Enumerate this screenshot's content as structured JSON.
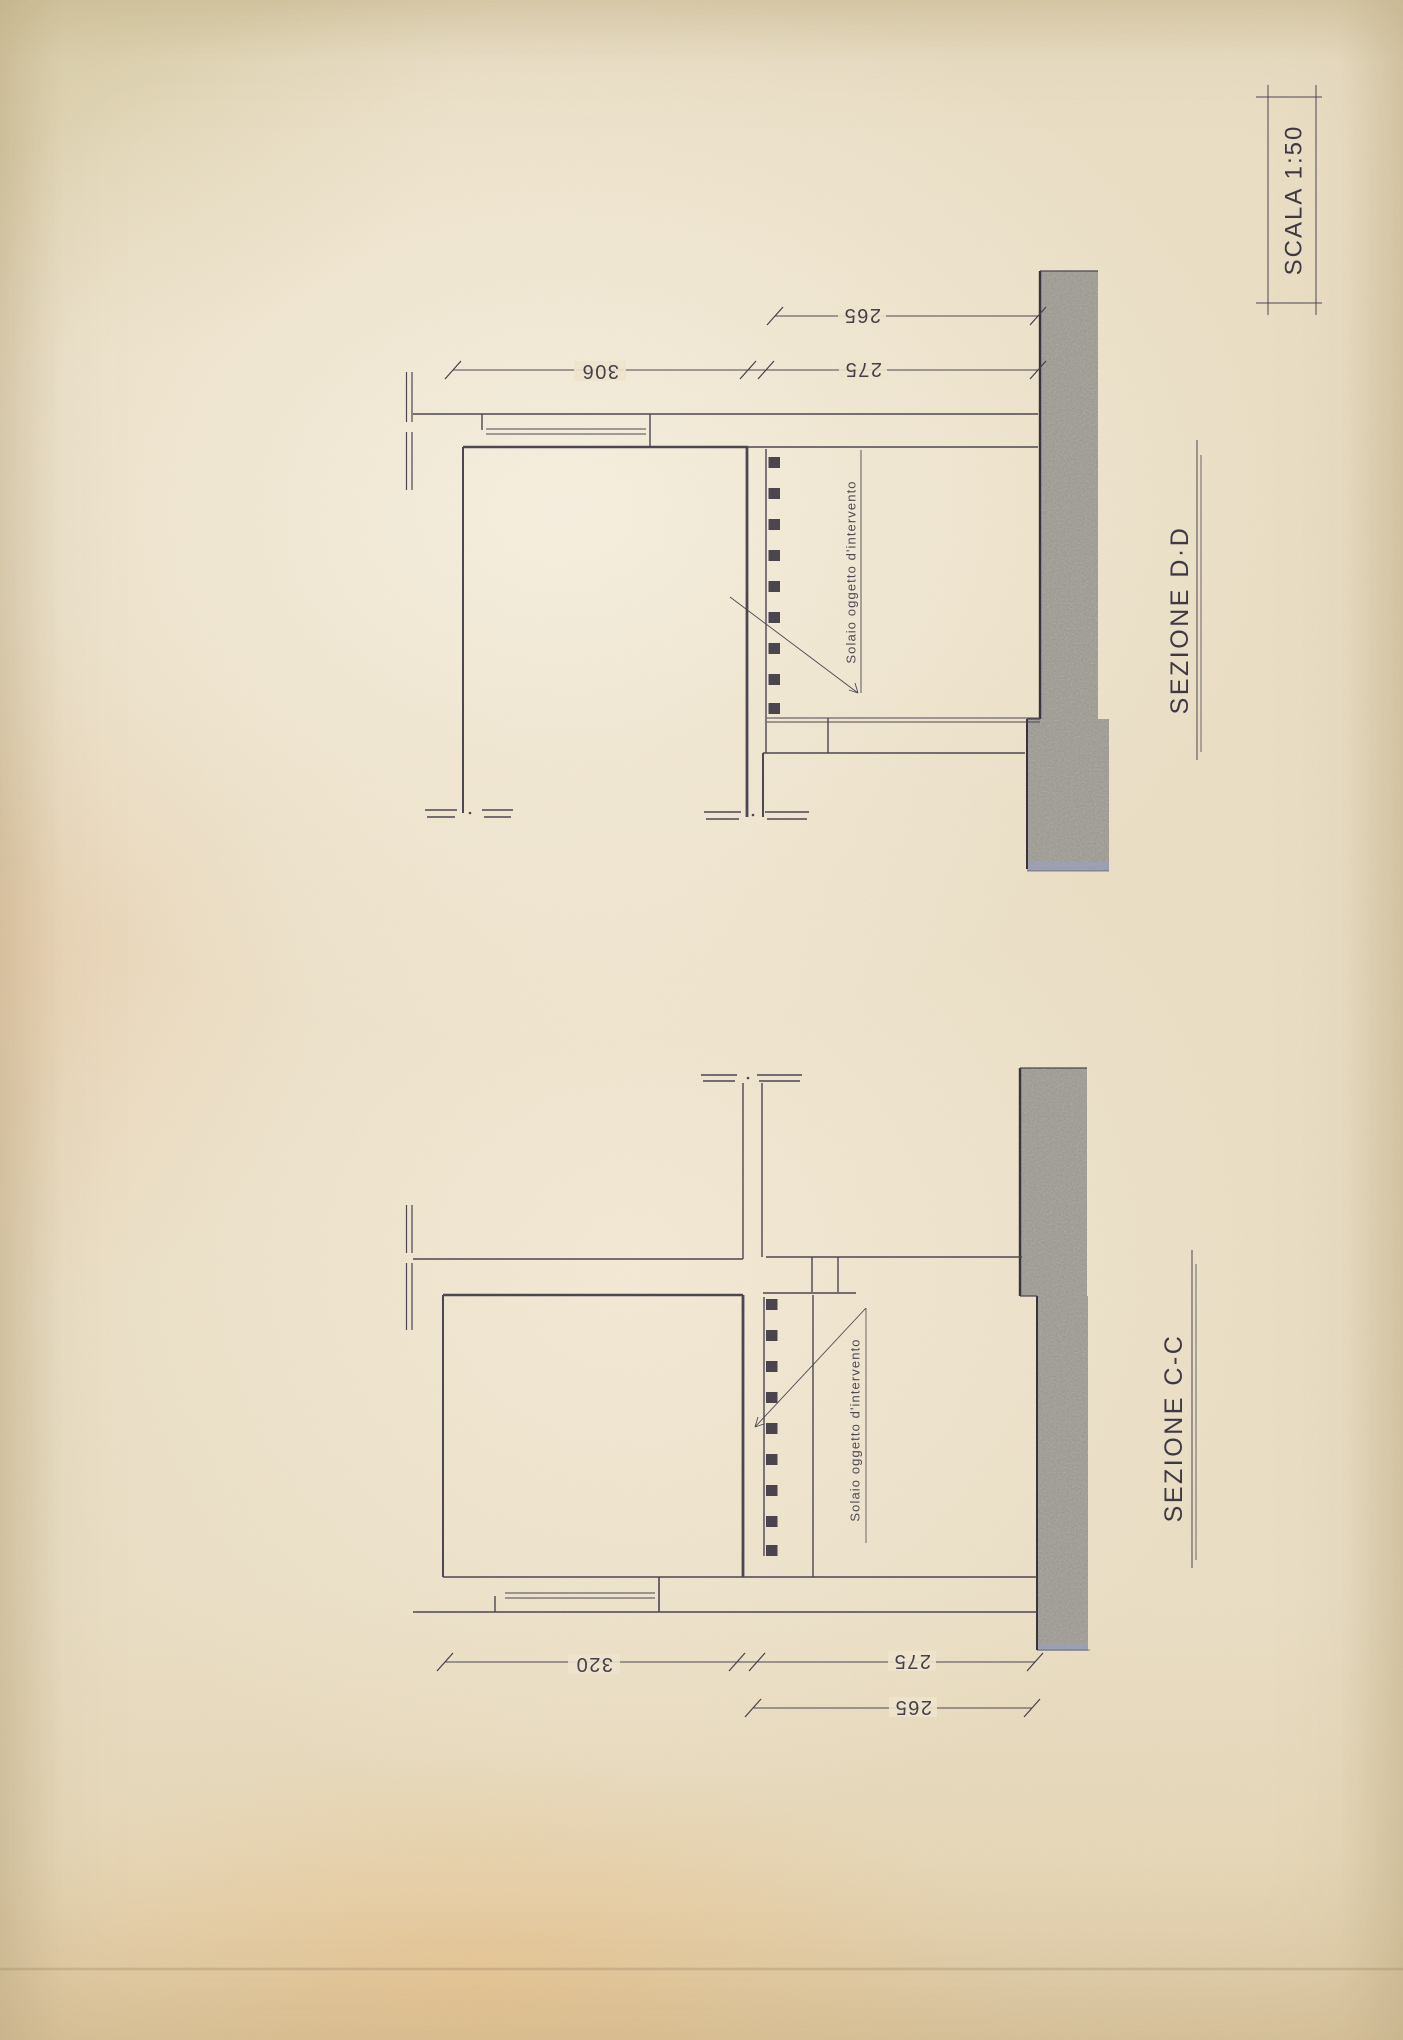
{
  "drawing": {
    "scale_label": "SCALA  1:50",
    "sections": [
      {
        "title": "SEZIONE   D·D",
        "annotation": "Solaio oggetto d'intervento",
        "dims": {
          "room": "306",
          "span": "275",
          "inner": "265"
        }
      },
      {
        "title": "SEZIONE   C-C",
        "annotation": "Solaio oggetto d'intervento",
        "dims": {
          "room": "320",
          "span": "275",
          "inner": "265"
        }
      }
    ],
    "colors": {
      "paper": "#ebdfc5",
      "ink": "#4a4350",
      "ground": "#9c9890",
      "ground_edge": "#9aa0ba"
    }
  }
}
